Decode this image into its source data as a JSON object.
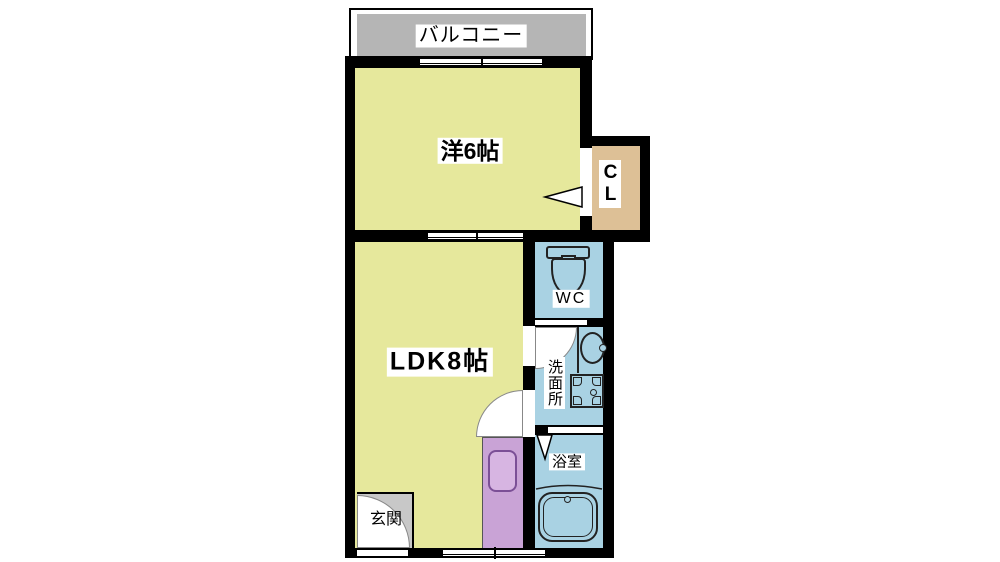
{
  "title": "1K/1LDK apartment floor plan (madori)",
  "colors": {
    "wall": "#000000",
    "room_yellow": "#e6e89c",
    "wet_blue": "#a9d2e3",
    "closet_tan": "#ddc096",
    "kitchen_purple": "#c9a3d6",
    "kitchen_sink_fill": "#d7b5e2",
    "kitchen_sink_stroke": "#7b4f96",
    "balcony_gray": "#b5b5b5",
    "entrance_gray": "#c8c8c8",
    "icon_stroke": "#222222",
    "label_bg": "#ffffff"
  },
  "rooms": {
    "balcony": {
      "label": "バルコニー"
    },
    "western_room": {
      "label": "洋6帖"
    },
    "closet": {
      "label": "CL"
    },
    "toilet": {
      "label": "WC"
    },
    "washroom": {
      "label": "洗面所"
    },
    "bathroom": {
      "label": "浴室"
    },
    "ldk": {
      "label": "LDK8帖"
    },
    "entrance": {
      "label": "玄関"
    }
  },
  "fixtures": [
    "toilet-icon",
    "vanity-sink-icon",
    "washing-machine-icon",
    "bathtub-icon",
    "kitchen-sink-icon",
    "door-swing",
    "door-leaf",
    "window"
  ]
}
